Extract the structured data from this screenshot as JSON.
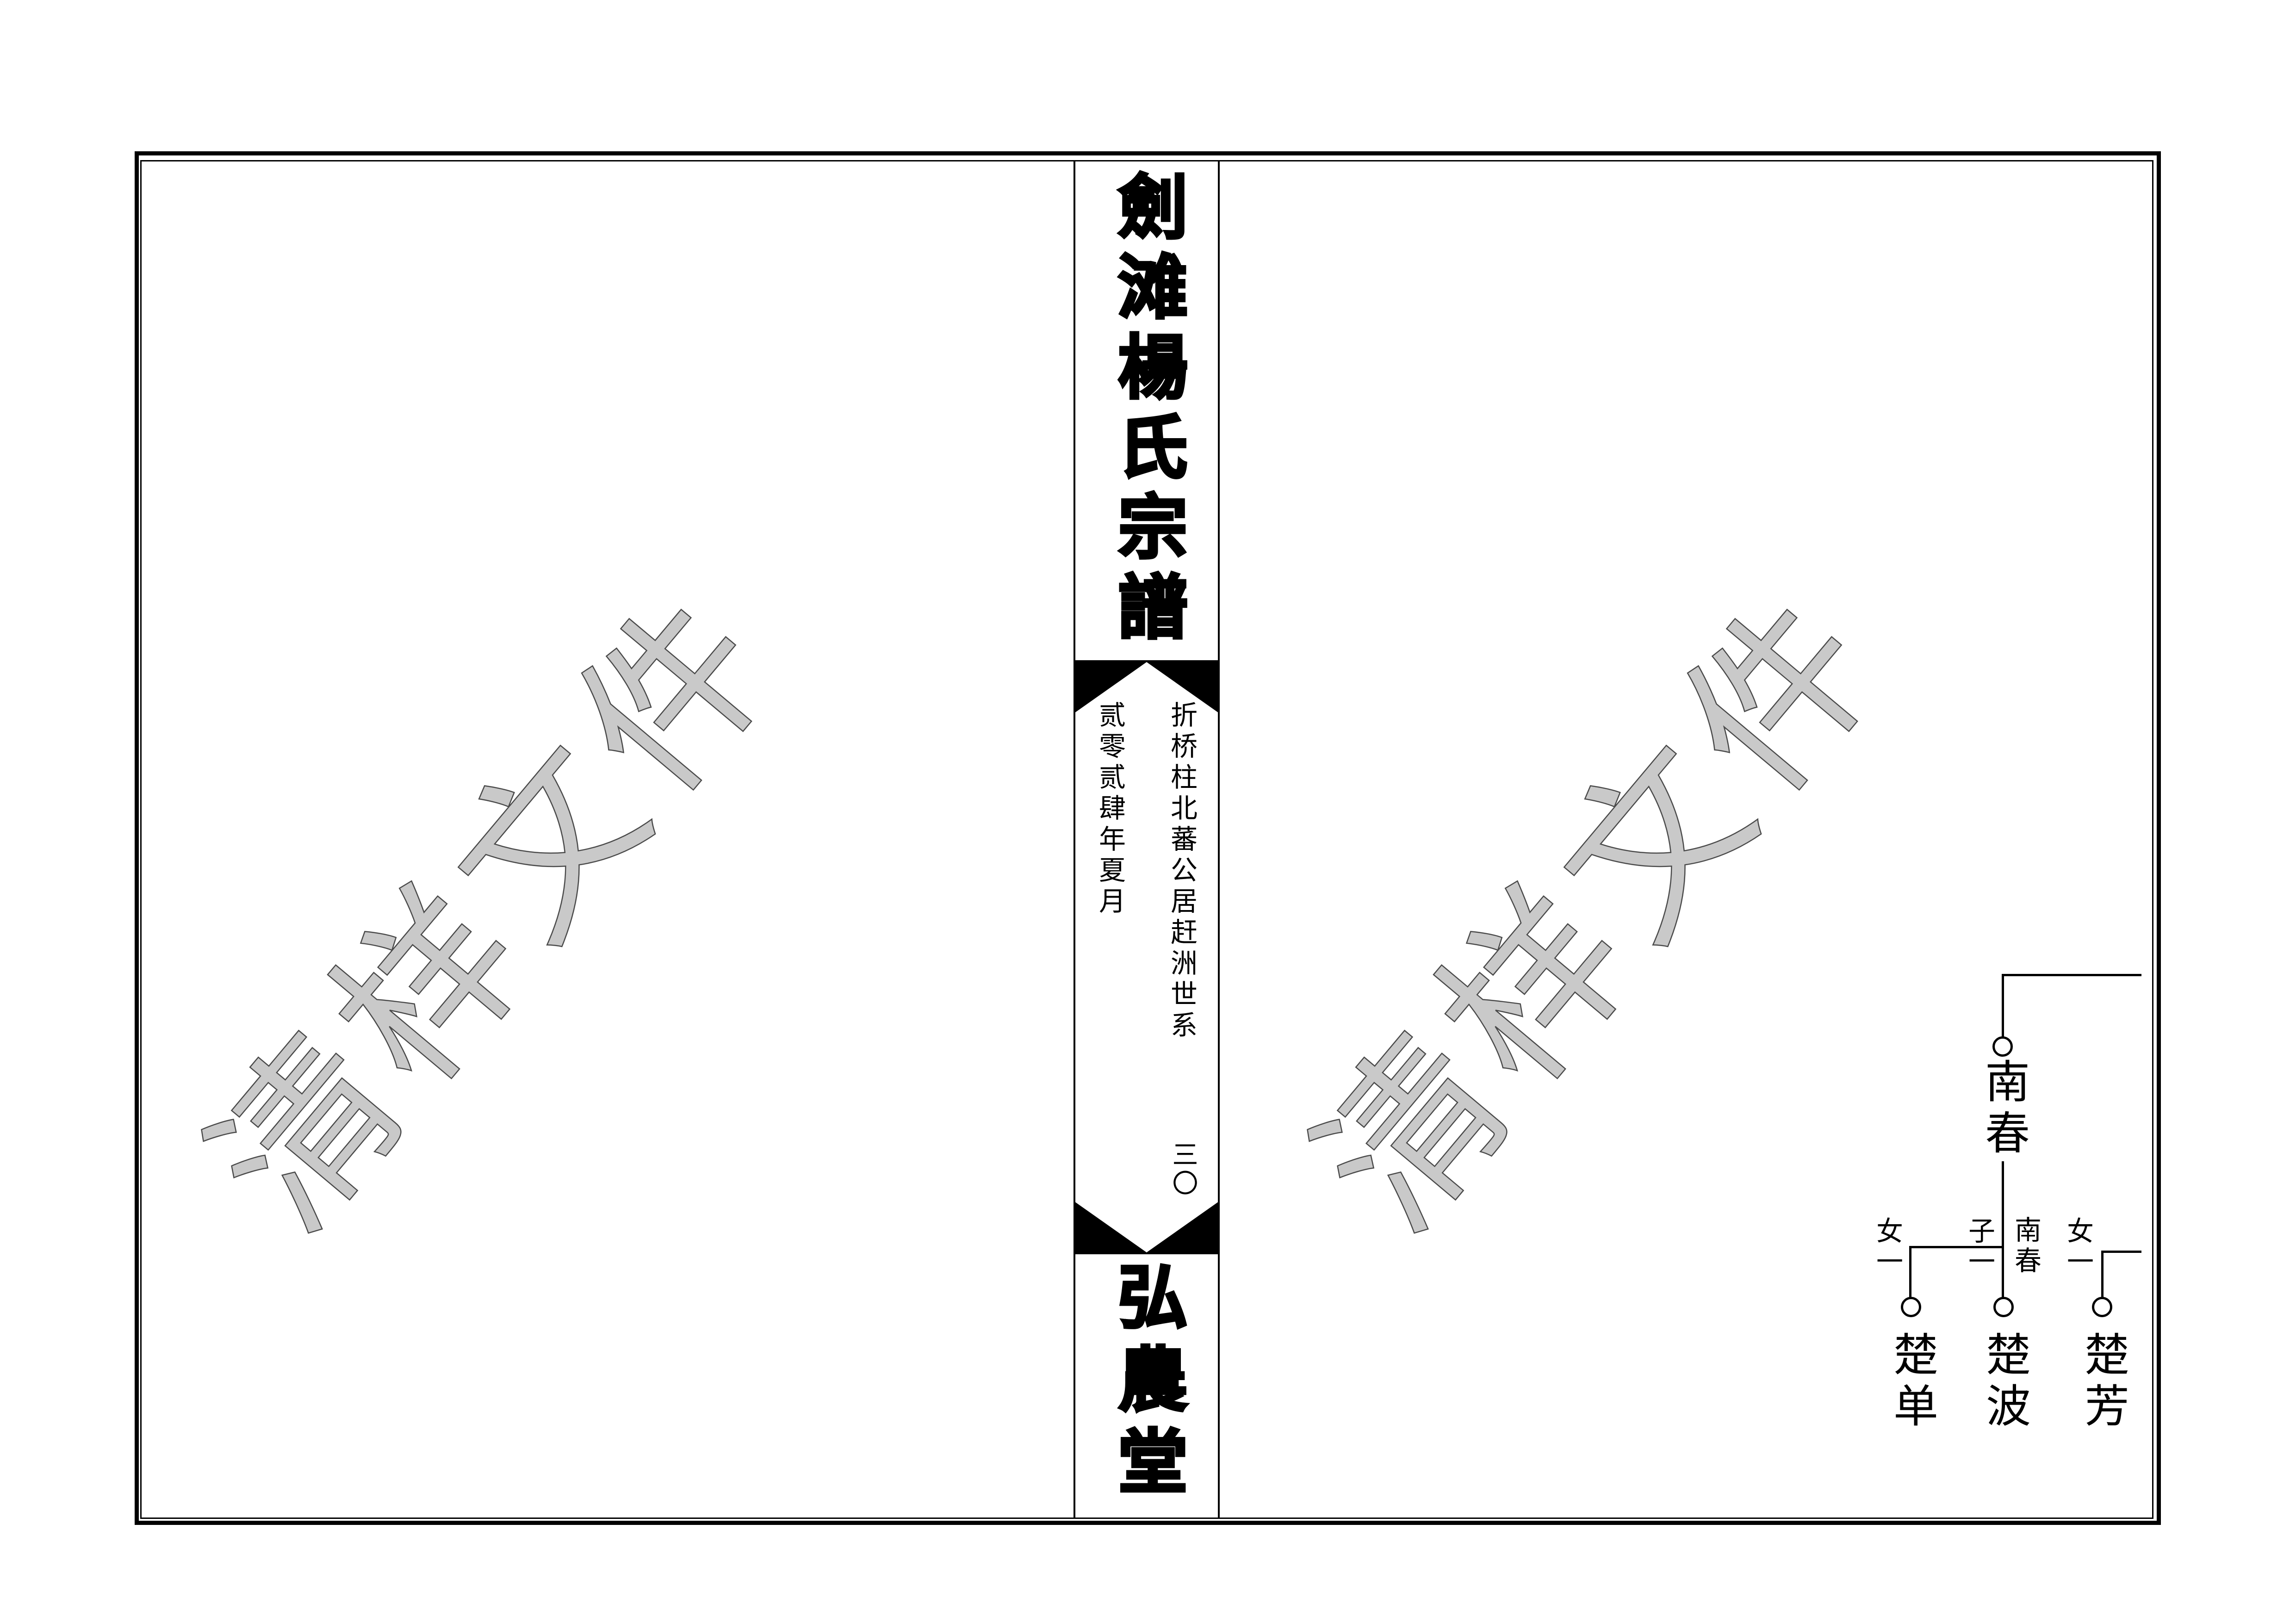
{
  "spine": {
    "title": "劍滩楊氏宗譜",
    "lineage_heading": "折桥柱北蕃公居赶洲世系",
    "date": "贰零贰肆年夏月",
    "page_number": "三〇",
    "hall_name": "弘農堂"
  },
  "watermark": {
    "text": "清样文件",
    "fill_color": "#c9c9c9",
    "outline_color": "#4a4a4a"
  },
  "tree": {
    "ancestor": {
      "name": "南春"
    },
    "junction_parent_label": "南春",
    "children": [
      {
        "label": "女一",
        "name": "楚单"
      },
      {
        "label": "子一",
        "name": "楚波"
      },
      {
        "label": "女一",
        "name": "楚芳"
      }
    ]
  },
  "colors": {
    "ink": "#000000",
    "paper": "#ffffff"
  }
}
